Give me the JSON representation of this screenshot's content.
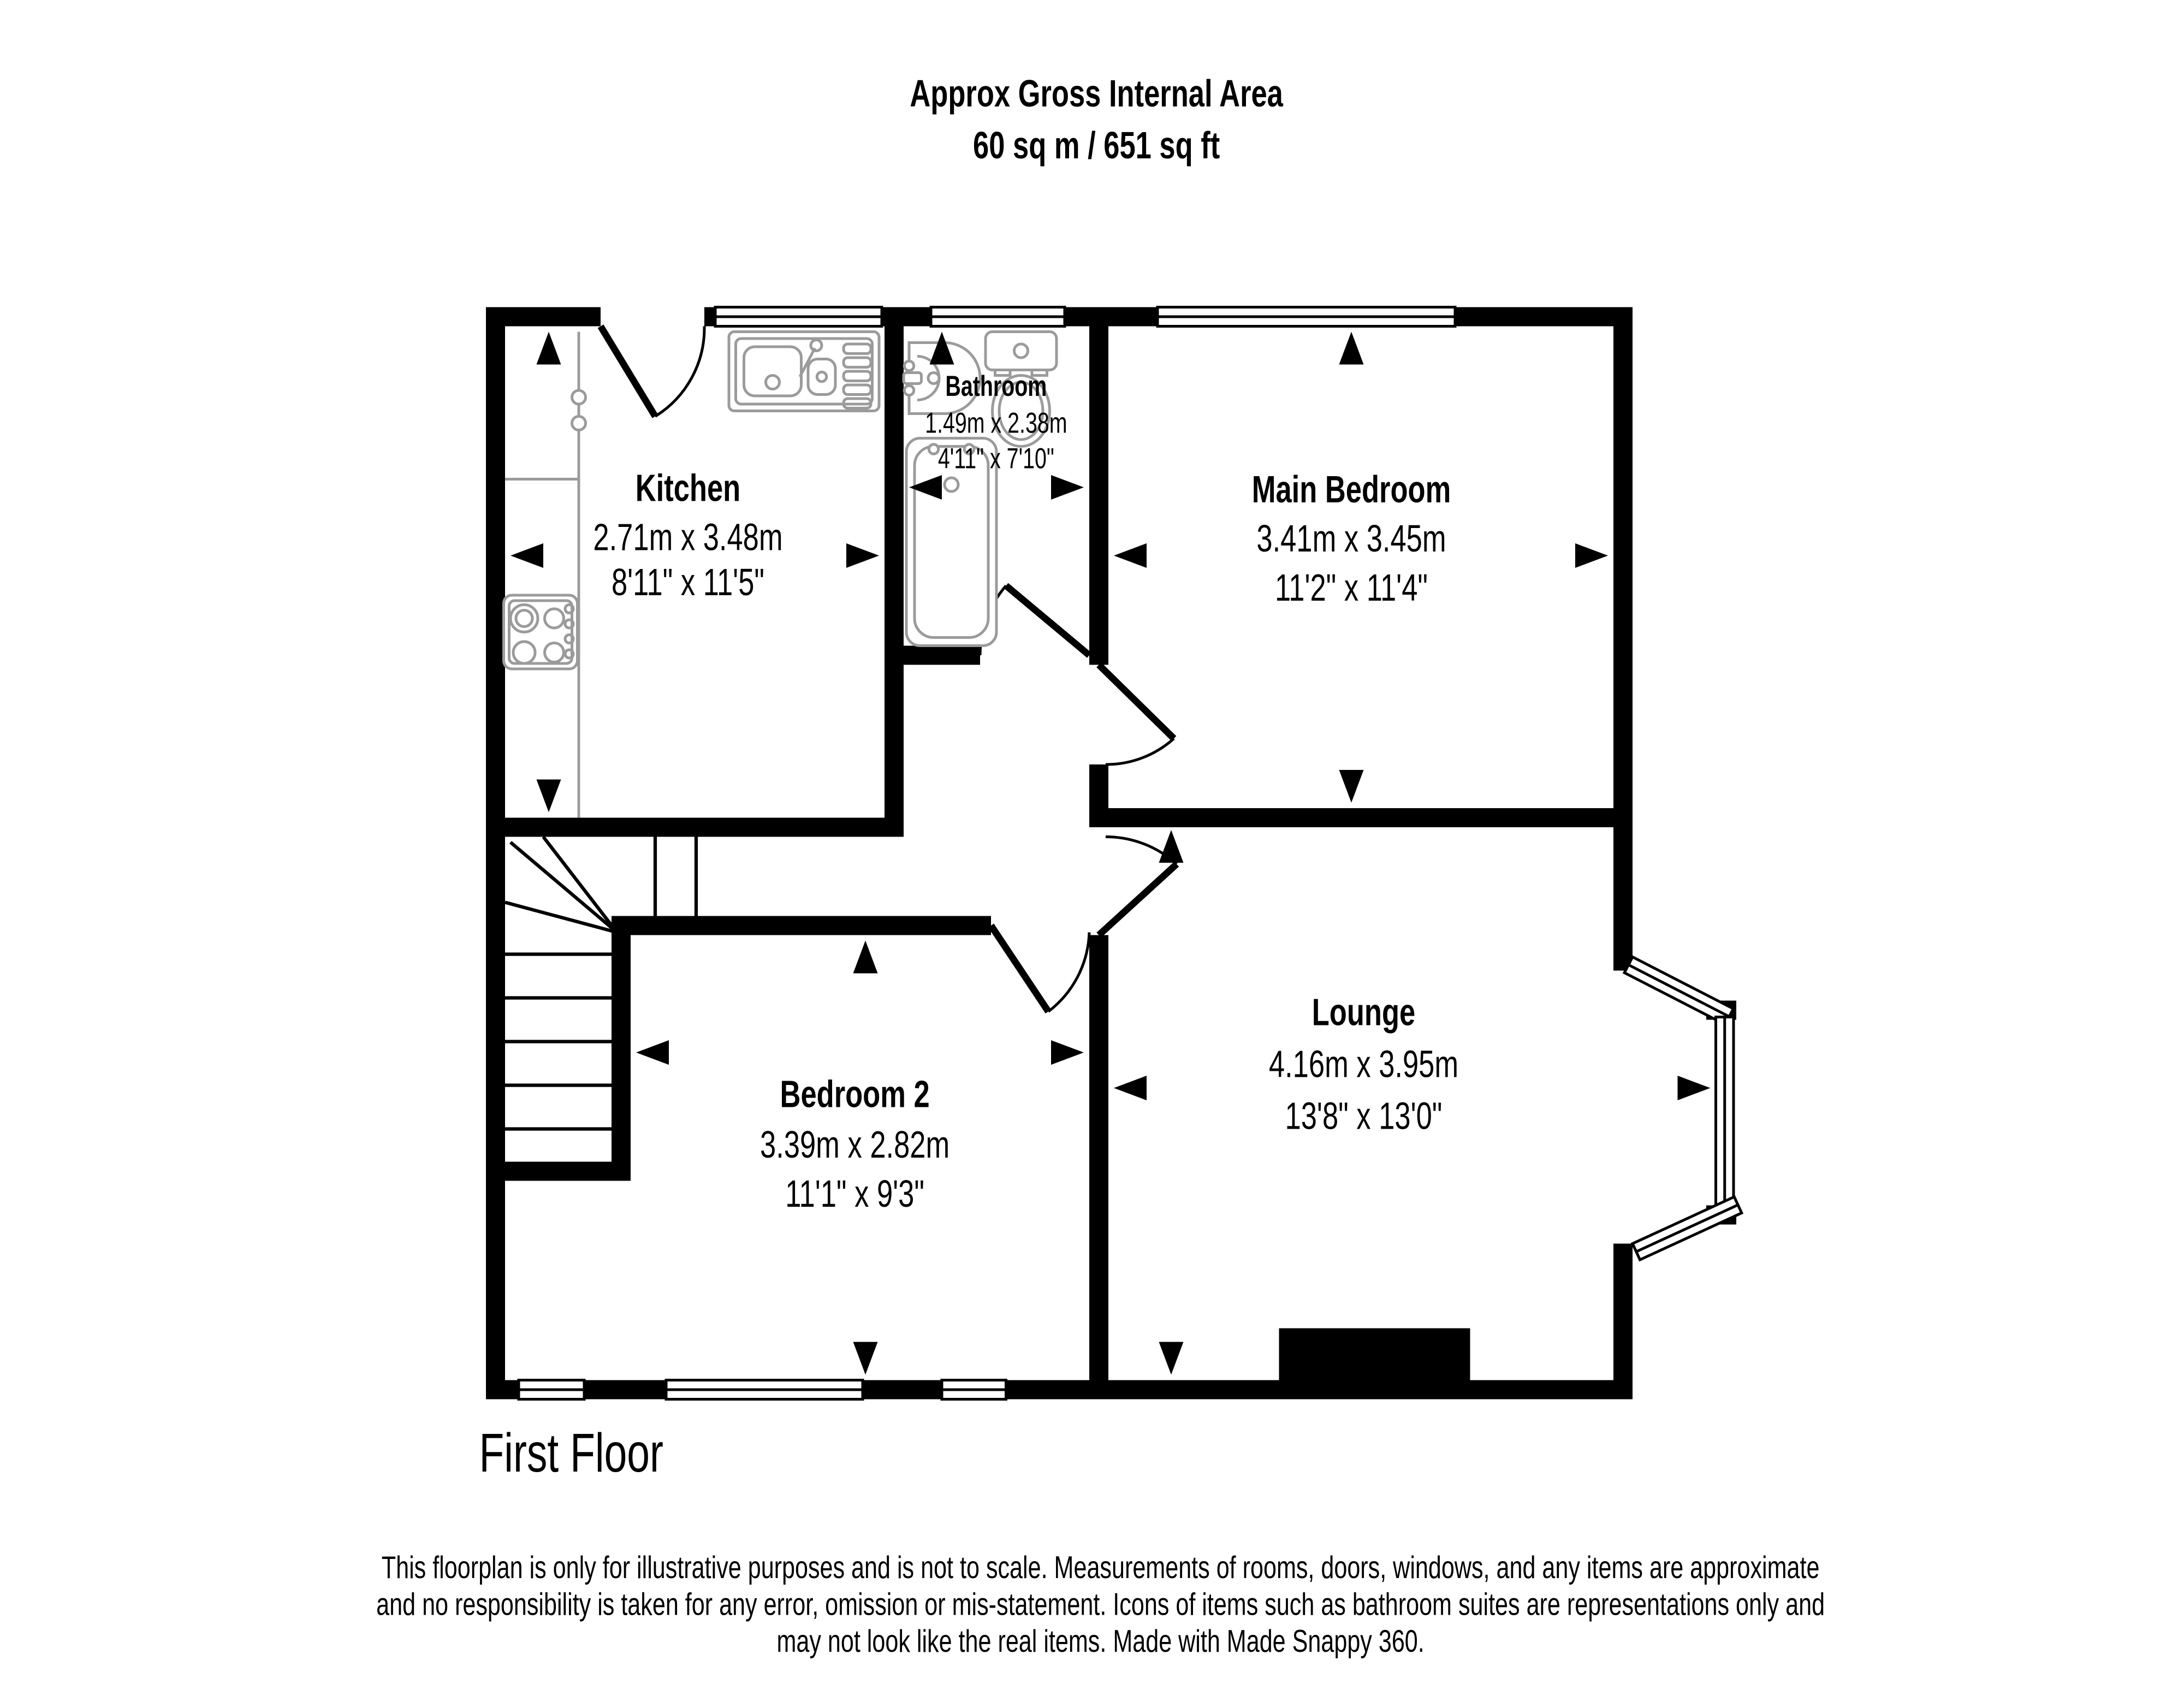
{
  "title": {
    "line1": "Approx Gross Internal Area",
    "line2": "60 sq m / 651 sq ft"
  },
  "rooms": {
    "kitchen": {
      "name": "Kitchen",
      "metric": "2.71m x 3.48m",
      "imperial": "8'11\" x 11'5\""
    },
    "bathroom": {
      "name": "Bathroom",
      "metric": "1.49m x 2.38m",
      "imperial": "4'11\" x 7'10\""
    },
    "main_bedroom": {
      "name": "Main Bedroom",
      "metric": "3.41m x 3.45m",
      "imperial": "11'2\" x 11'4\""
    },
    "bedroom2": {
      "name": "Bedroom 2",
      "metric": "3.39m x 2.82m",
      "imperial": "11'1\" x 9'3\""
    },
    "lounge": {
      "name": "Lounge",
      "metric": "4.16m x 3.95m",
      "imperial": "13'8\" x 13'0\""
    }
  },
  "floor_label": "First Floor",
  "disclaimer": {
    "line1": "This floorplan is only for illustrative purposes and is not to scale. Measurements of rooms, doors, windows, and any items are approximate",
    "line2": "and no responsibility is taken for any error, omission or mis-statement. Icons of items such as bathroom suites are representations only and",
    "line3": "may not look like the real items. Made with Made Snappy 360."
  },
  "colors": {
    "wall": "#000000",
    "fixture_outline": "#9b9b9b",
    "background": "#ffffff",
    "text": "#000000"
  },
  "icons": [
    "kitchen-sink-icon",
    "hob-icon",
    "counter-icon",
    "basin-icon",
    "toilet-icon",
    "bathtub-icon",
    "stairs-icon",
    "bay-window-icon",
    "chimney-breast-icon",
    "door-swing-icon",
    "measure-arrow-icon"
  ]
}
